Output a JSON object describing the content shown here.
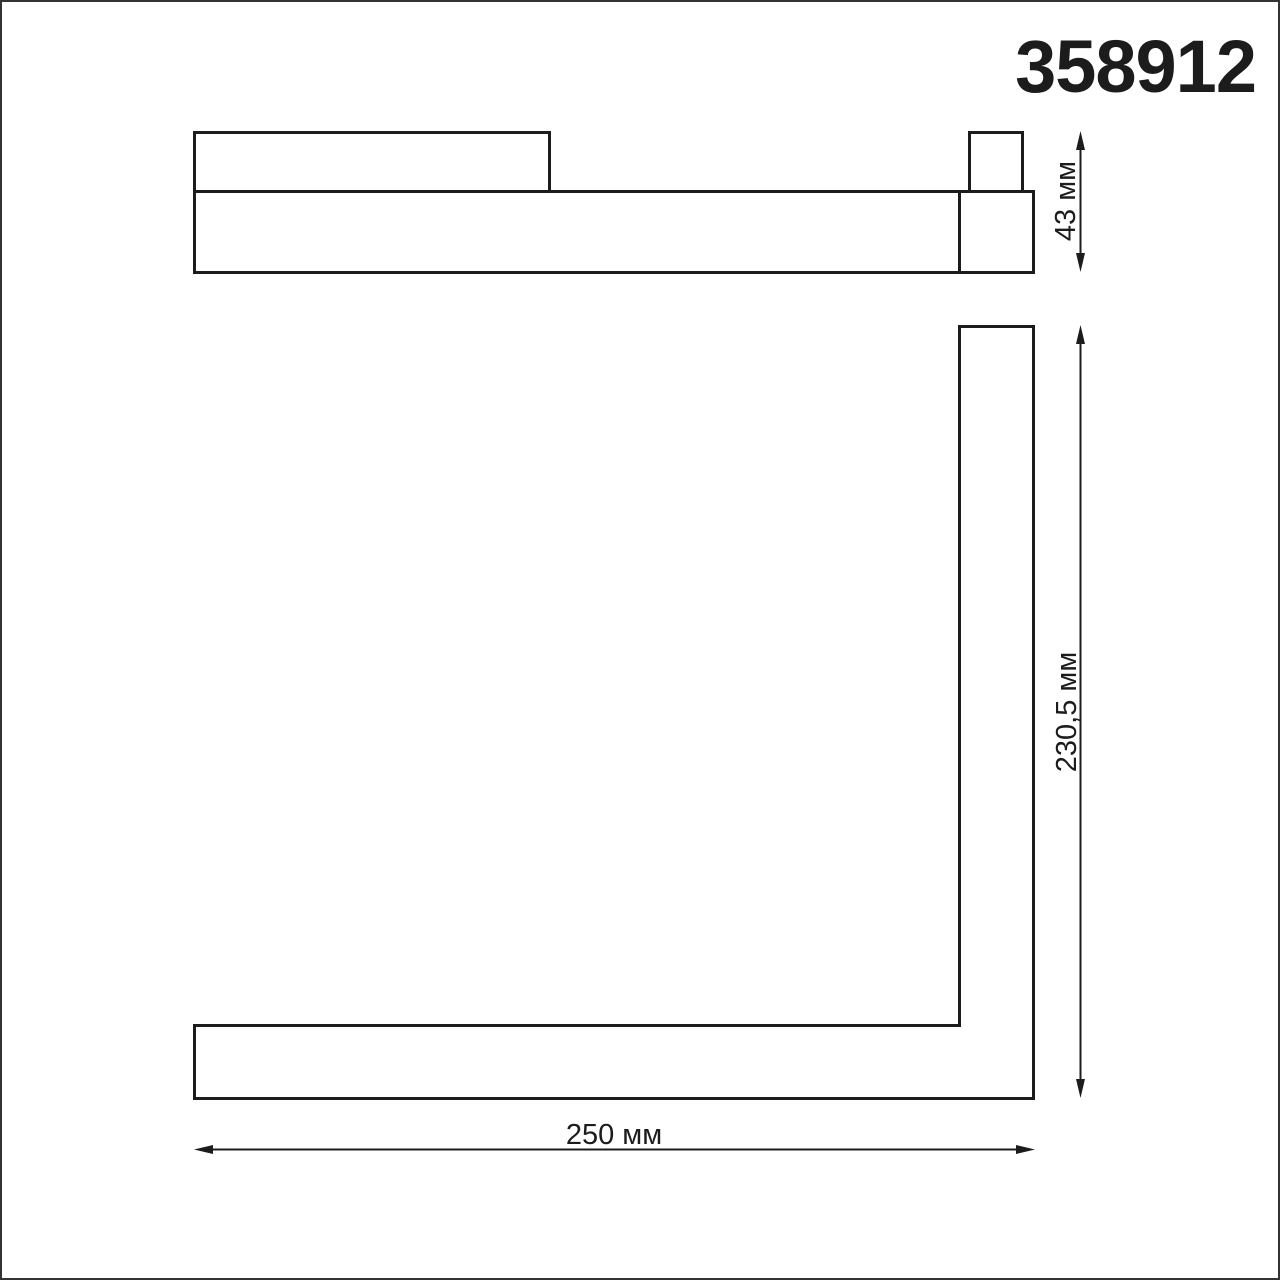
{
  "page": {
    "background": "#ffffff",
    "border_color": "#333333",
    "line_color": "#1c1c1c"
  },
  "header": {
    "article_number": "358912"
  },
  "drawing": {
    "kind": "technical-dimension-drawing",
    "views": [
      {
        "id": "side-view"
      },
      {
        "id": "front-view-l-profile"
      }
    ],
    "dimensions": [
      {
        "id": "profile-height",
        "label": "43 мм",
        "value": "43",
        "unit": "мм",
        "orientation": "vertical"
      },
      {
        "id": "vertical-length",
        "label": "230,5 мм",
        "value": "230,5",
        "unit": "мм",
        "orientation": "vertical"
      },
      {
        "id": "horizontal-length",
        "label": "250 мм",
        "value": "250",
        "unit": "мм",
        "orientation": "horizontal"
      }
    ]
  }
}
